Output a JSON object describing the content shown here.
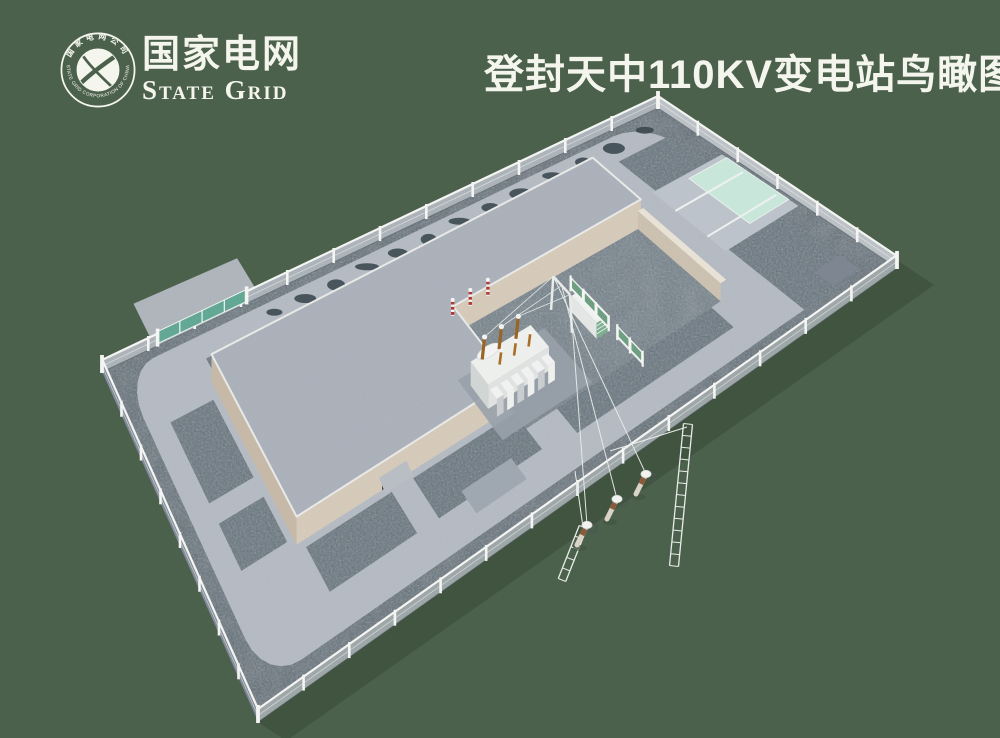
{
  "header": {
    "title": "登封天中110KV变电站鸟瞰图",
    "logo": {
      "name_cn": "国家电网",
      "name_en": "State Grid",
      "ring_top": "国家电网公司",
      "ring_bottom": "STATE GRID CORPORATION OF CHINA"
    }
  },
  "scene": {
    "type": "3d-birdseye-render",
    "subject": "Dengfeng Tianzhong 110kV substation compound",
    "colors": {
      "background": "#4c614c",
      "shadow": "#415440",
      "gravel": "#5a6872",
      "gravel_strip": "#64727c",
      "gravel_courtyard": "#6e7c86",
      "paving": "#b5bbc3",
      "paving_apron": "#bdc3ca",
      "roof": "#abb1ba",
      "roof_edge": "#e9eae8",
      "wall_tan": "#d8ccba",
      "wall_tan_dark": "#c6b9a7",
      "wall_court": "#cec2b0",
      "wall_court_top": "#e8e2d6",
      "fence_white": "#f4f5f3",
      "fence_panel_far": "#aab3ba",
      "fence_panel_ne": "#bcc3c8",
      "fence_panel_se": "#9aa4a6",
      "fence_panel_ws": "#7b8793",
      "gate_teal": "#63a795",
      "pad_mint": "#c8e6da",
      "pad_dark": "#7e8791",
      "pad_mid": "#9fa7b0",
      "safety_green": "#6f9f82",
      "transformer_white": "#e9ebe9",
      "transformer_front": "#dfe2e0",
      "transformer_left": "#d1d5d4",
      "radiator_shade": "#c9cdd0",
      "bushing_brown": "#9a6524",
      "arrester_red": "#b03a36",
      "bush": "#3a474d",
      "conductor": "#e8ece9",
      "pole_shaft": "#d9d3c8",
      "pole_brown": "#8a5a3a",
      "door_dark": "#2b2f33"
    }
  }
}
